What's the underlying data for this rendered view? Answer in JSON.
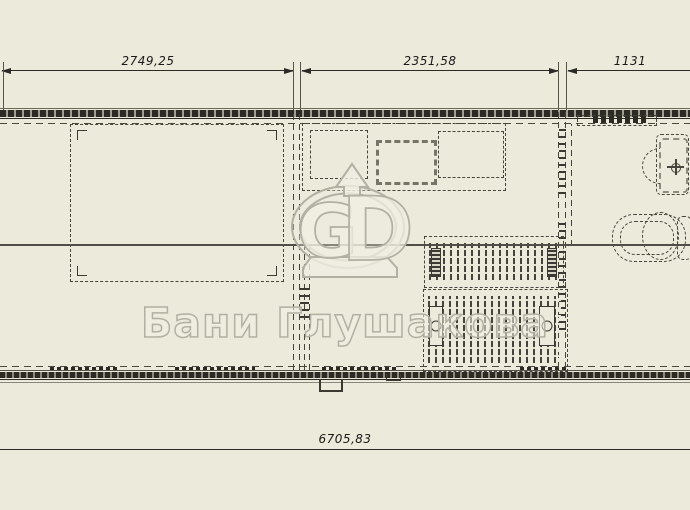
{
  "plan": {
    "dimensions": {
      "top": [
        "2749,25",
        "2351,58",
        "1131"
      ],
      "bottom": "6705,83"
    },
    "watermark": {
      "brand": "Бани Глушакова",
      "monogram": {
        "g": "G",
        "d": "D"
      }
    },
    "colors": {
      "background": "#ECEADB",
      "line_dark": "#2B2A24",
      "line_gray": "#8E8C7C",
      "watermark_stroke": "#B2B0A2",
      "dimension_text": "#1A1A1A"
    }
  }
}
